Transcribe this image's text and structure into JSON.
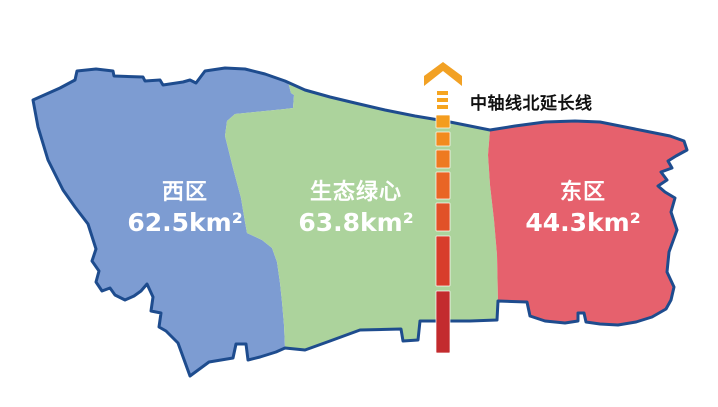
{
  "page": {
    "background": "#FFFFFF"
  },
  "map": {
    "outline_color": "#1E4C8E",
    "description": "three-district planning map"
  },
  "regions": {
    "west": {
      "name": "西区",
      "area": "62.5km²",
      "color": "#7D9CD2",
      "text_color": "#FFFFFF"
    },
    "green_heart": {
      "name": "生态绿心",
      "area": "63.8km²",
      "color": "#ACD39C",
      "text_color": "#FFFFFF"
    },
    "east": {
      "name": "东区",
      "area": "44.3km²",
      "color": "#E6616D",
      "text_color": "#FFFFFF"
    }
  },
  "axis_line": {
    "label": "中轴线北延长线",
    "label_color": "#111111",
    "arrow_color": "#F2A124",
    "tick_color": "#F6A51F",
    "segment_colors": [
      "#F49D1F",
      "#F28B1F",
      "#EE7A21",
      "#E96525",
      "#E15128",
      "#D83D2B",
      "#C32B2E"
    ]
  }
}
